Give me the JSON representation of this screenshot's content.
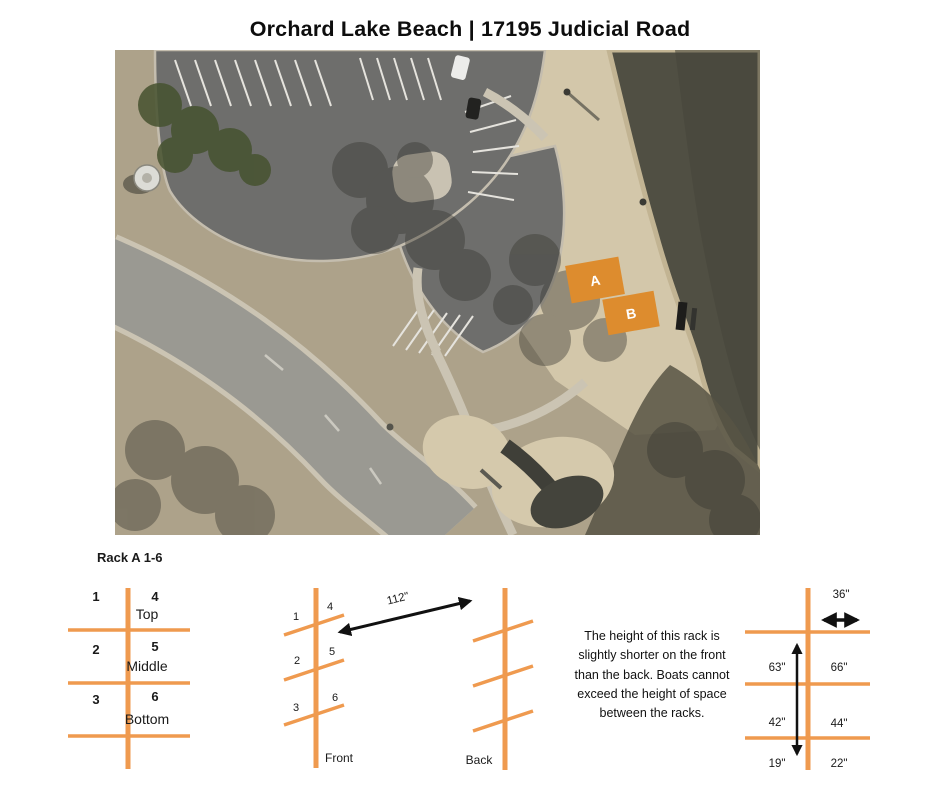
{
  "title": "Orchard Lake Beach | 17195 Judicial Road",
  "aerial_map": {
    "rack_a_label": "A",
    "rack_b_label": "B",
    "colors": {
      "rack_overlay": "#dd8c2e",
      "water": "#504f43",
      "beach_sand": "#d3c7aa",
      "asphalt_lot": "#6e6e6c",
      "road": "#9a9992",
      "grass": "#ada28a"
    }
  },
  "rack_diagram": {
    "heading": "Rack A 1-6",
    "accent_color": "#ef9a4f",
    "front_view": {
      "numbers_left": [
        "1",
        "2",
        "3"
      ],
      "numbers_right": [
        "4",
        "5",
        "6"
      ],
      "levels": [
        "Top",
        "Middle",
        "Bottom"
      ]
    },
    "side_view": {
      "numbers_left": [
        "1",
        "2",
        "3"
      ],
      "numbers_right": [
        "4",
        "5",
        "6"
      ],
      "front_label": "Front",
      "back_label": "Back",
      "depth": "112\""
    },
    "measurements": {
      "width_top": "36\"",
      "left_column": [
        "63\"",
        "42\"",
        "19\""
      ],
      "right_column": [
        "66\"",
        "44\"",
        "22\""
      ]
    },
    "note": "The height of this rack is slightly shorter on the front than the back. Boats cannot exceed the height of space between the racks."
  }
}
